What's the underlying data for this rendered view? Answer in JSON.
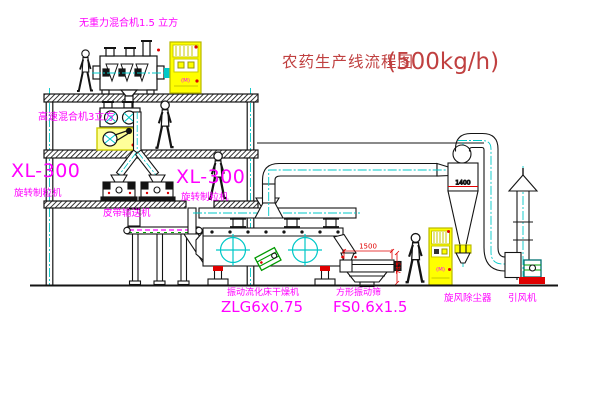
{
  "title": {
    "name_cn": "农药生产线流程图",
    "capacity": "(500kg/h)"
  },
  "labels": {
    "gravity_mixer": "无重力混合机1.5 立方",
    "highspeed_mixer": "高速混合机3立方",
    "granulator_model_left": "XL-300",
    "granulator_name_left": "旋转制粒机",
    "granulator_model_right": "XL-300",
    "granulator_name_right": "旋转制粒机",
    "belt_conveyor": "皮带输送机",
    "dryer_name": "振动流化床干燥机",
    "dryer_model": "ZLG6x0.75",
    "sieve_name": "方形振动筛",
    "sieve_model": "FS0.6x1.5",
    "cyclone": "旋风除尘器",
    "fan": "引风机"
  },
  "dimensions": {
    "sieve_length": "1500",
    "sieve_height": "745",
    "cyclone_dim": "1400"
  },
  "cabinet_badge": "(M)",
  "colors": {
    "label_magenta": "#FF00FF",
    "title_red": "#C04040",
    "dimension_red": "#E00000",
    "centerline_cyan": "#00C8C8",
    "equipment_yellow": "#FFFF00",
    "motor_green": "#00A000",
    "line_black": "#141414",
    "background": "#FFFFFF"
  }
}
